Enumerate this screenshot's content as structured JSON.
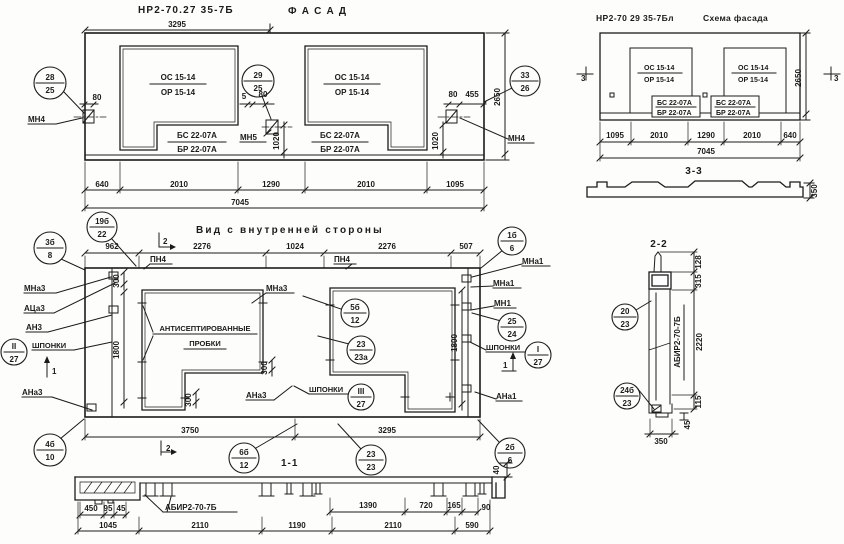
{
  "facade": {
    "title": "НР2-70.27 35-7Б",
    "subtitle": "Ф А С А Д",
    "dim_top": "3295",
    "win1_os": "ОС 15-14",
    "win1_or": "ОР 15-14",
    "win1_bs": "БС 22-07А",
    "win1_br": "БР 22-07А",
    "win2_os": "ОС 15-14",
    "win2_or": "ОР 15-14",
    "win2_bs": "БС 22-07А",
    "win2_br": "БР 22-07А",
    "c1_top": "28",
    "c1_bot": "25",
    "c2_top": "29",
    "c2_bot": "25",
    "c3_top": "33",
    "c3_bot": "26",
    "mn4_left": "МН4",
    "mn5": "МН5",
    "mn4_right": "МН4",
    "d80_left": "80",
    "d5": "5",
    "d80_mid": "80",
    "d80_right": "80",
    "d455": "455",
    "d1020_mid": "1020",
    "d1020_right": "1020",
    "d2650": "2650",
    "dims_bottom": [
      "640",
      "2010",
      "1290",
      "2010",
      "1095"
    ],
    "d_total": "7045"
  },
  "scheme": {
    "title": "НР2-70 29 35-7Бл",
    "subtitle": "Схема фасада",
    "win1_os": "ОС 15-14",
    "win1_or": "ОР 15-14",
    "win2_os": "ОС 15-14",
    "win2_or": "ОР 15-14",
    "box1_bs": "БС 22-07А",
    "box1_br": "БР 22-07А",
    "box2_bs": "БС 22-07А",
    "box2_br": "БР 22-07А",
    "mark_left": "3",
    "mark_right": "3",
    "d2650": "2650",
    "dims_bottom": [
      "1095",
      "2010",
      "1290",
      "2010",
      "640"
    ],
    "d_total": "7045",
    "section": "3-3",
    "d350": "350"
  },
  "inner": {
    "title": "Вид с внутренней стороны",
    "dims_top": [
      "962",
      "2276",
      "1024",
      "2276",
      "507"
    ],
    "pn4_left": "ПН4",
    "pn4_right": "ПН4",
    "plugs1": "АНТИСЕПТИРОВАННЫЕ",
    "plugs2": "ПРОБКИ",
    "c3b_t": "3б",
    "c3b_b": "8",
    "c19b_t": "19б",
    "c19b_b": "22",
    "c1b_t": "1б",
    "c1b_b": "6",
    "c5b_t": "5б",
    "c5b_b": "12",
    "c23a_t": "23",
    "c23a_b": "23а",
    "c25_t": "25",
    "c25_b": "24",
    "cII_t": "II",
    "cII_b": "27",
    "cIII_t": "III",
    "cIII_b": "27",
    "cI_t": "I",
    "cI_b": "27",
    "c4b_t": "4б",
    "c4b_b": "10",
    "c2b_t": "2б",
    "c2b_b": "6",
    "mna3_left": "МНа3",
    "aca3": "АЦа3",
    "an3": "АН3",
    "shponki_left": "ШПОНКИ",
    "ana3_left": "АНа3",
    "mna3_mid": "МНа3",
    "ana3_mid": "АНа3",
    "shponki_mid": "ШПОНКИ",
    "mna1_a": "МНа1",
    "mna1_b": "МНа1",
    "mn1": "МН1",
    "shponki_right": "ШПОНКИ",
    "ana1": "АНа1",
    "d300_a": "300",
    "d300_b": "300",
    "d300_c": "300",
    "d1800_left": "1800",
    "d1800_right": "1800",
    "d3750": "3750",
    "d3295": "3295",
    "mark2_top": "2",
    "mark2_bot": "2",
    "mark1_left": "1",
    "mark1_right": "1"
  },
  "s11": {
    "label": "1-1",
    "mark": "АБИР2-70-7Б",
    "c6b_t": "6б",
    "c6b_b": "12",
    "c23_t": "23",
    "c23_b": "23",
    "d450": "450",
    "d95": "95",
    "d45": "45",
    "d1390": "1390",
    "d720": "720",
    "d165": "165",
    "d90": "90",
    "d40": "40",
    "dims_bottom": [
      "1045",
      "2110",
      "1190",
      "2110",
      "590"
    ]
  },
  "s22": {
    "label": "2-2",
    "mark": "АБИР2-70-7Б",
    "c20_t": "20",
    "c20_b": "23",
    "c24b_t": "24б",
    "c24b_b": "23",
    "d128": "128",
    "d315": "315",
    "d2220": "2220",
    "d115": "115",
    "d45": "45",
    "d350": "350"
  }
}
